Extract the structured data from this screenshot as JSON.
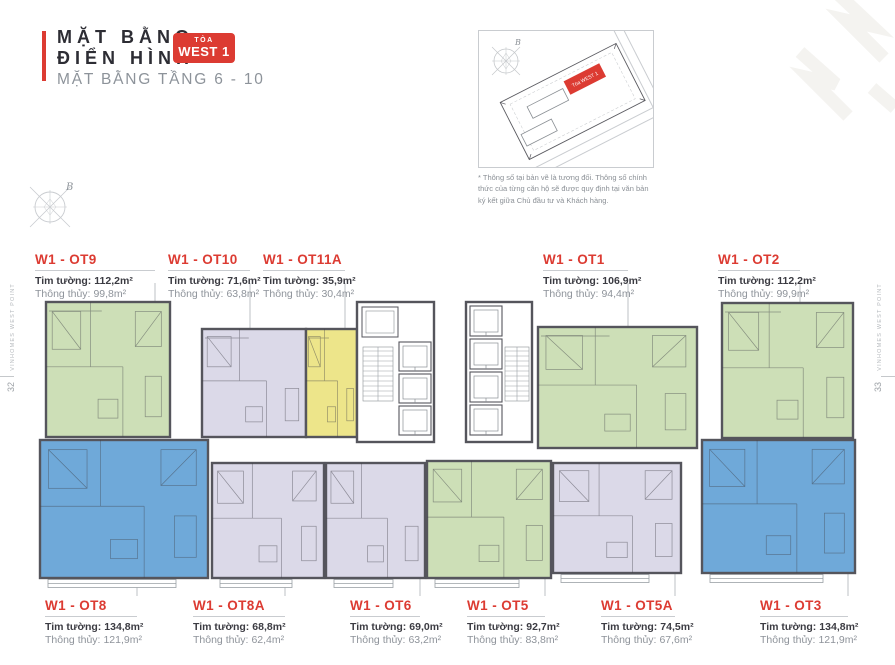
{
  "page": {
    "title_line1": "MẶT BẰNG",
    "title_line2": "ĐIỂN HÌNH",
    "badge_small": "TÒA",
    "badge_large": "WEST 1",
    "subtitle": "MẶT BẰNG TẦNG 6 - 10",
    "left_margin_text": "VINHOMES WEST POINT",
    "right_margin_text": "VINHOMES WEST POINT",
    "page_number_left": "32",
    "page_number_right": "33",
    "compass_label": "B"
  },
  "sitemap": {
    "building_label": "Tòa WEST 1",
    "compass_label": "B",
    "disclaimer": "* Thông số tại bản vẽ là tương đối. Thông số chính thức của từng căn hộ sẽ được quy định tại văn bản ký kết giữa Chủ đầu tư và Khách hàng."
  },
  "labels": {
    "tim": "Tim tường:",
    "thong": "Thông thủy:"
  },
  "units_top": [
    {
      "name": "W1 - OT9",
      "tim": "112,2m²",
      "thong": "99,8m²"
    },
    {
      "name": "W1 - OT10",
      "tim": "71,6m²",
      "thong": "63,8m²"
    },
    {
      "name": "W1 - OT11A",
      "tim": "35,9m²",
      "thong": "30,4m²"
    },
    {
      "name": "W1 - OT1",
      "tim": "106,9m²",
      "thong": "94,4m²"
    },
    {
      "name": "W1 - OT2",
      "tim": "112,2m²",
      "thong": "99,9m²"
    }
  ],
  "units_bottom": [
    {
      "name": "W1 - OT8",
      "tim": "134,8m²",
      "thong": "121,9m²"
    },
    {
      "name": "W1 - OT8A",
      "tim": "68,8m²",
      "thong": "62,4m²"
    },
    {
      "name": "W1 - OT6",
      "tim": "69,0m²",
      "thong": "63,2m²"
    },
    {
      "name": "W1 - OT5",
      "tim": "92,7m²",
      "thong": "83,8m²"
    },
    {
      "name": "W1 - OT5A",
      "tim": "74,5m²",
      "thong": "67,6m²"
    },
    {
      "name": "W1 - OT3",
      "tim": "134,8m²",
      "thong": "121,9m²"
    }
  ],
  "colors": {
    "accent_red": "#DC3B32",
    "wall": "#55555C",
    "line_gray": "#C9CCD0",
    "text_dark": "#2D2D34",
    "text_gray": "#8D939A",
    "units": {
      "green": "#CDDFB7",
      "lavender": "#DBD9E8",
      "yellow": "#EDE58A",
      "blue": "#6FA9D9"
    }
  },
  "floorplan": {
    "units": [
      {
        "id": "w1-ot9",
        "color": "green",
        "row": "top",
        "x": 46,
        "y": 302,
        "w": 124,
        "h": 135
      },
      {
        "id": "w1-ot10",
        "color": "lavender",
        "row": "top",
        "x": 202,
        "y": 329,
        "w": 104,
        "h": 108
      },
      {
        "id": "w1-ot11a",
        "color": "yellow",
        "row": "top",
        "x": 306,
        "y": 329,
        "w": 51,
        "h": 108
      },
      {
        "id": "w1-ot1",
        "color": "green",
        "row": "top",
        "x": 538,
        "y": 327,
        "w": 159,
        "h": 121
      },
      {
        "id": "w1-ot2",
        "color": "green",
        "row": "top",
        "x": 722,
        "y": 303,
        "w": 131,
        "h": 135
      },
      {
        "id": "w1-ot8",
        "color": "blue",
        "row": "bottom",
        "x": 40,
        "y": 440,
        "w": 168,
        "h": 138
      },
      {
        "id": "w1-ot8a",
        "color": "lavender",
        "row": "bottom",
        "x": 212,
        "y": 463,
        "w": 112,
        "h": 115
      },
      {
        "id": "w1-ot6",
        "color": "lavender",
        "row": "bottom",
        "x": 326,
        "y": 463,
        "w": 99,
        "h": 115
      },
      {
        "id": "w1-ot5",
        "color": "green",
        "row": "bottom",
        "x": 427,
        "y": 461,
        "w": 124,
        "h": 117
      },
      {
        "id": "w1-ot5a",
        "color": "lavender",
        "row": "bottom",
        "x": 553,
        "y": 463,
        "w": 128,
        "h": 110
      },
      {
        "id": "w1-ot3",
        "color": "blue",
        "row": "bottom",
        "x": 702,
        "y": 440,
        "w": 153,
        "h": 133
      }
    ],
    "cores": [
      {
        "x": 357,
        "y": 302,
        "w": 77,
        "h": 140,
        "room": {
          "x": 362,
          "y": 307,
          "w": 36,
          "h": 30
        },
        "stairs": {
          "x": 363,
          "y": 347,
          "w": 30,
          "h": 54
        },
        "shaft": {
          "x": 399,
          "y": 342,
          "w": 32,
          "cells": 3,
          "cellH": 29
        }
      },
      {
        "x": 466,
        "y": 302,
        "w": 66,
        "h": 140,
        "stairs": {
          "x": 505,
          "y": 347,
          "w": 24,
          "h": 54
        },
        "shaft": {
          "x": 470,
          "y": 306,
          "w": 32,
          "cells": 4,
          "cellH": 30
        }
      }
    ],
    "leaders": [
      {
        "x": 155,
        "y1": 283,
        "y2": 302
      },
      {
        "x": 250,
        "y1": 283,
        "y2": 329
      },
      {
        "x": 345,
        "y1": 283,
        "y2": 329
      },
      {
        "x": 628,
        "y1": 283,
        "y2": 327
      },
      {
        "x": 800,
        "y1": 283,
        "y2": 303
      },
      {
        "x": 137,
        "y1": 578,
        "y2": 596
      },
      {
        "x": 285,
        "y1": 578,
        "y2": 596
      },
      {
        "x": 420,
        "y1": 578,
        "y2": 596
      },
      {
        "x": 545,
        "y1": 578,
        "y2": 596
      },
      {
        "x": 675,
        "y1": 573,
        "y2": 596
      },
      {
        "x": 848,
        "y1": 573,
        "y2": 596
      }
    ]
  }
}
